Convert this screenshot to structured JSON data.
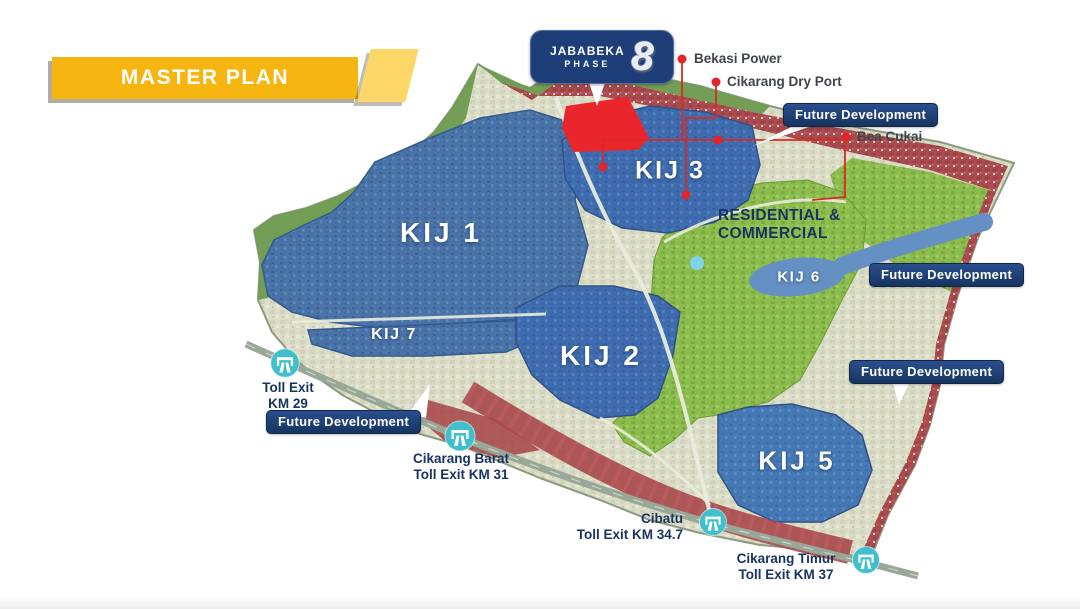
{
  "banner": {
    "title": "MASTER PLAN"
  },
  "logo": {
    "brand": "JABABEKA",
    "phase_word": "PHASE",
    "phase_number": "8"
  },
  "badges": {
    "future_development": "Future Development"
  },
  "zones": {
    "kij1": "KIJ 1",
    "kij2": "KIJ 2",
    "kij3": "KIJ 3",
    "kij5": "KIJ 5",
    "kij6": "KIJ 6",
    "kij7": "KIJ 7",
    "residential_line1": "RESIDENTIAL &",
    "residential_line2": "COMMERCIAL"
  },
  "pois": {
    "bekasi_power": "Bekasi Power",
    "cikarang_dry_port": "Cikarang Dry Port",
    "bea_cukai": "Bea Cukai"
  },
  "toll_exits": [
    {
      "line1": "Toll Exit",
      "line2": "KM 29"
    },
    {
      "line1": "Cikarang Barat",
      "line2": "Toll Exit KM 31"
    },
    {
      "line1": "Cibatu",
      "line2": "Toll Exit KM 34.7"
    },
    {
      "line1": "Cikarang Timur",
      "line2": "Toll Exit KM 37"
    }
  ],
  "icons": {
    "toll_exit_icon": "toll-gate-icon",
    "poi_marker": "red-dot-marker"
  },
  "colors": {
    "banner_yellow": "#f6b511",
    "banner_tab_yellow": "#fcd768",
    "navy": "#1d3e78",
    "zone_blue": "#4a74a8",
    "zone_blue_bright": "#3f6cae",
    "zone_blue_light": "#4679b4",
    "kij6_blue": "#6490c4",
    "residential_green": "#8cbb4e",
    "urban_red": "#a84a4e",
    "site_red": "#e8262b",
    "marker_red": "#e3252a",
    "toll_teal": "#3fc0cc",
    "label_navy": "#17335f"
  }
}
